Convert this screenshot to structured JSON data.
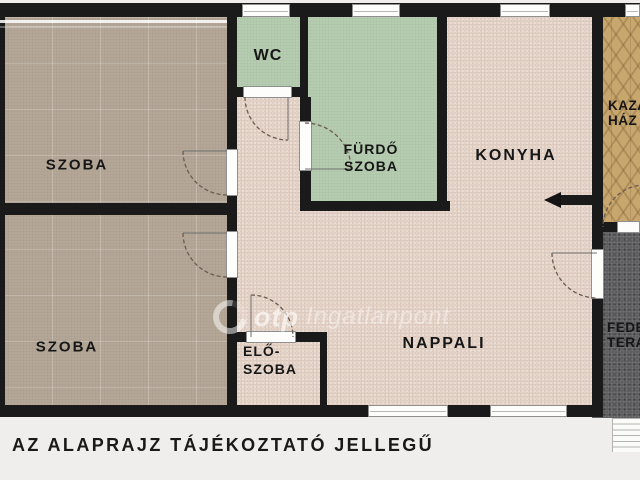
{
  "plan": {
    "caption": "AZ ALAPRAJZ TÁJÉKOZTATÓ JELLEGŰ",
    "watermark": {
      "brand": "otp",
      "name": "Ingatlanpont"
    },
    "rooms": {
      "szoba1": {
        "label": "SZOBA"
      },
      "szoba2": {
        "label": "SZOBA"
      },
      "wc": {
        "label": "WC"
      },
      "furdoszoba": {
        "line1": "FÜRDŐ",
        "line2": "SZOBA"
      },
      "konyha": {
        "label": "KONYHA"
      },
      "nappali": {
        "label": "NAPPALI"
      },
      "eloszoba": {
        "line1": "ELŐ-",
        "line2": "SZOBA"
      },
      "kazanhaz": {
        "line1": "KAZÁN",
        "line2": "HÁZ"
      },
      "fedett_terasz": {
        "line1": "FEDETT",
        "line2": "TERASZ"
      }
    },
    "colors": {
      "wall": "#1a1a1a",
      "room_beige": "#b6a999",
      "room_green": "#b8cfb2",
      "room_pink": "#e5d2c6",
      "room_wood": "#c8a76f",
      "terrace_gray": "#59595b",
      "background": "#efeeec"
    }
  }
}
